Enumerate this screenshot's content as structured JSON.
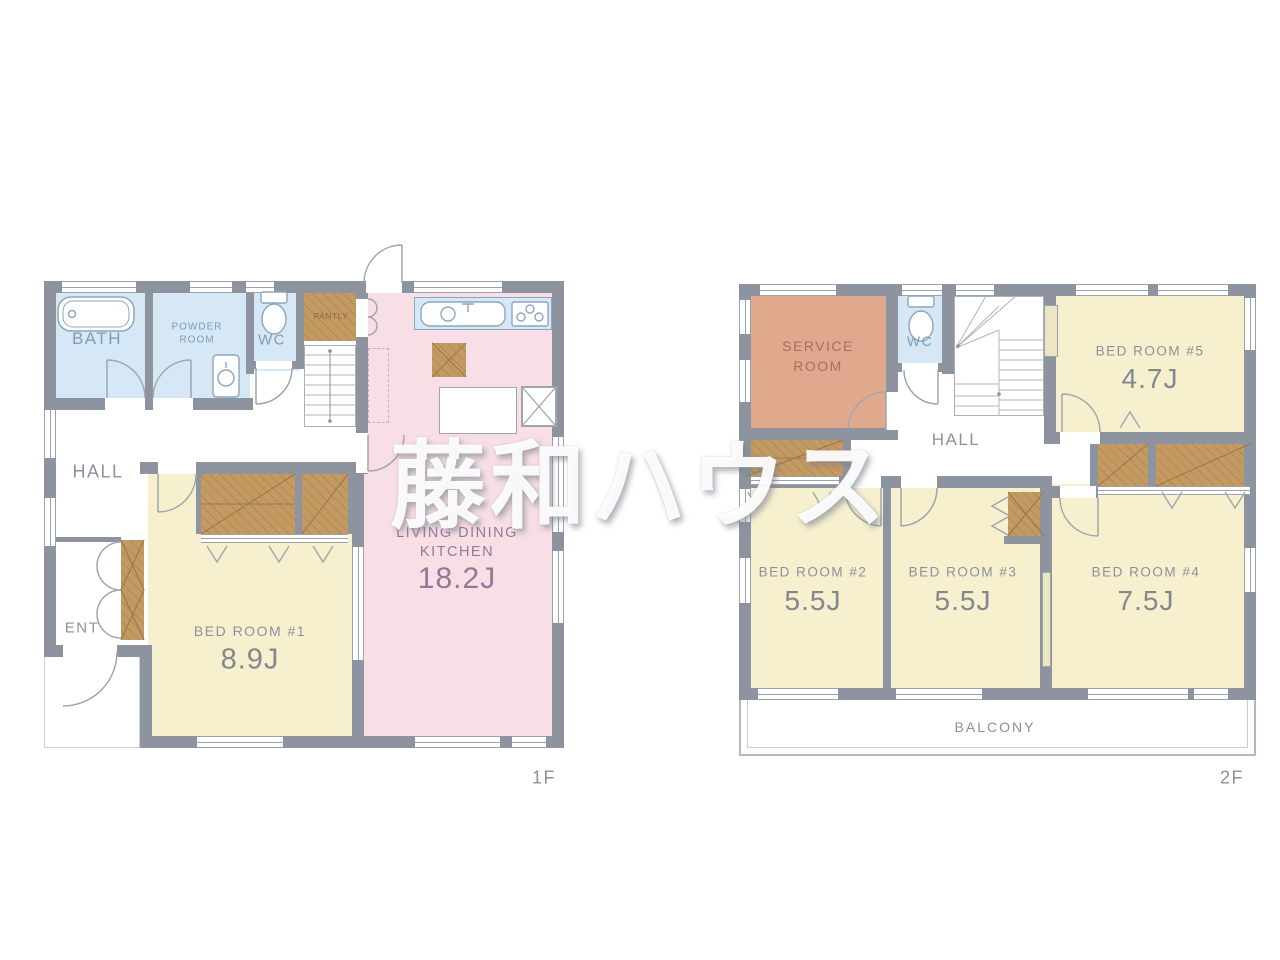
{
  "watermark_text": "藤和ハウス",
  "colors": {
    "wall": "#8e93a0",
    "water_room_fill": "#d6e8f5",
    "tatami_room_fill": "#f6f0cf",
    "ldk_fill": "#f8dfe5",
    "closet_fill": "#c49a63",
    "service_room_fill": "#e0a98e",
    "label_blue": "#7d9cb5",
    "label_gray": "#8d919c",
    "label_purple": "#9a7598",
    "label_salmon": "#a8705a",
    "label_brown": "#8a6a45"
  },
  "floor1": {
    "label": "1F",
    "bath": "BATH",
    "powder_room_line1": "POWDER",
    "powder_room_line2": "ROOM",
    "wc": "WC",
    "pantry": "PANTLY",
    "hall": "HALL",
    "entrance": "ENT",
    "bedroom1_name": "BED ROOM #1",
    "bedroom1_area": "8.9J",
    "ldk_line1": "LIVING DINING",
    "ldk_line2": "KITCHEN",
    "ldk_area": "18.2J"
  },
  "floor2": {
    "label": "2F",
    "service_room_line1": "SERVICE",
    "service_room_line2": "ROOM",
    "wc": "WC",
    "hall": "HALL",
    "bedroom5_name": "BED ROOM #5",
    "bedroom5_area": "4.7J",
    "bedroom2_name": "BED ROOM #2",
    "bedroom2_area": "5.5J",
    "bedroom3_name": "BED ROOM #3",
    "bedroom3_area": "5.5J",
    "bedroom4_name": "BED ROOM #4",
    "bedroom4_area": "7.5J",
    "balcony": "BALCONY"
  }
}
